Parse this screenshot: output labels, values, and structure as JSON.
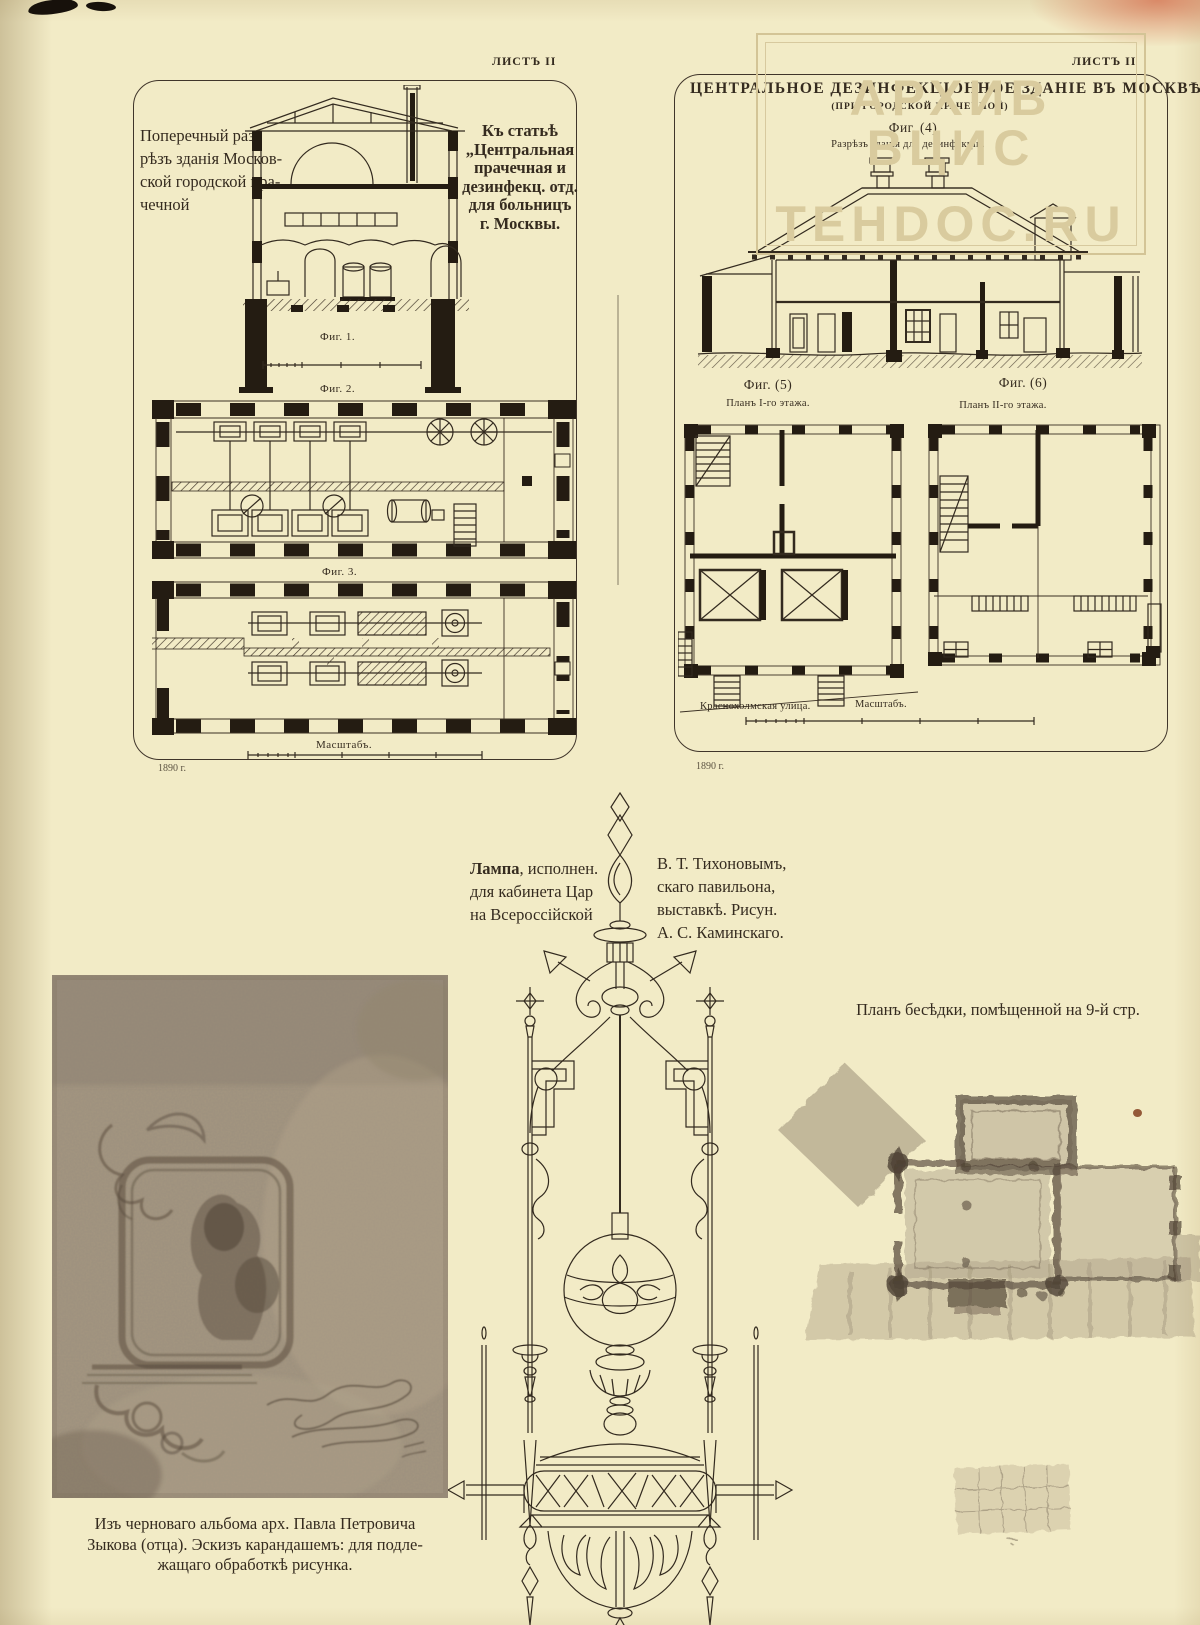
{
  "page": {
    "sheet_label_left": "ЛИСТЪ II",
    "sheet_label_right": "ЛИСТЪ II",
    "watermark_line1": "АРХИВ ВЦИС",
    "watermark_line2": "TEHDOC.RU",
    "colors": {
      "paper": "#f2ebc6",
      "ink": "#332a1f",
      "watermark": "#d9cb9e",
      "photo_tone": "#a49580",
      "wash_tone": "#81725f"
    }
  },
  "left_plate": {
    "section_caption_lines": [
      "Поперечный раз-",
      "рѣзъ зданія Москов-",
      "ской городской пра-",
      "чечной"
    ],
    "article_note_lines": [
      "Къ статьѣ",
      "„Центральная",
      "прачечная и",
      "дезинфекц. отд.",
      "для больницъ",
      "г. Москвы."
    ],
    "fig1": "Фиг. 1.",
    "fig2": "Фиг. 2.",
    "fig3": "Фиг. 3.",
    "scale": "Масштабъ.",
    "year": "1890 г."
  },
  "right_plate": {
    "title": "ЦЕНТРАЛЬНОЕ ДЕЗИНФЕКЦІОННОЕ ЗДАНІЕ ВЪ МОСКВѢ.",
    "subtitle": "(ПРИ ГОРОДСКОЙ ПРАЧЕЧНОЙ)",
    "fig4": "Фиг. (4)",
    "fig4_caption": "Разрѣзъ зданія для дезинфекціи.",
    "fig5": "Фиг. (5)",
    "fig5_caption": "Планъ I-го этажа.",
    "fig6": "Фиг. (6)",
    "fig6_caption": "Планъ II-го этажа.",
    "street": "Краснохолмская улица.",
    "scale": "Масштабъ.",
    "year": "1890 г."
  },
  "lamp": {
    "caption_left_bold": "Лампа",
    "caption_left_lines": [
      ", исполнен.",
      "для кабинета Цар",
      "на Всероссійской"
    ],
    "caption_right_lines": [
      "В. Т. Тихоновымъ,",
      "скаго павильона,",
      "выставкѣ. Рисун.",
      "А. С. Каминскаго."
    ]
  },
  "gazebo": {
    "caption": "Планъ бесѣдки, помѣщенной на 9-й стр."
  },
  "sketch": {
    "caption_lines": [
      "Изъ черноваго альбома арх. Павла Петровича",
      "Зыкова (отца). Эскизъ карандашемъ: для подле-",
      "жащаго обработкѣ рисунка."
    ]
  }
}
